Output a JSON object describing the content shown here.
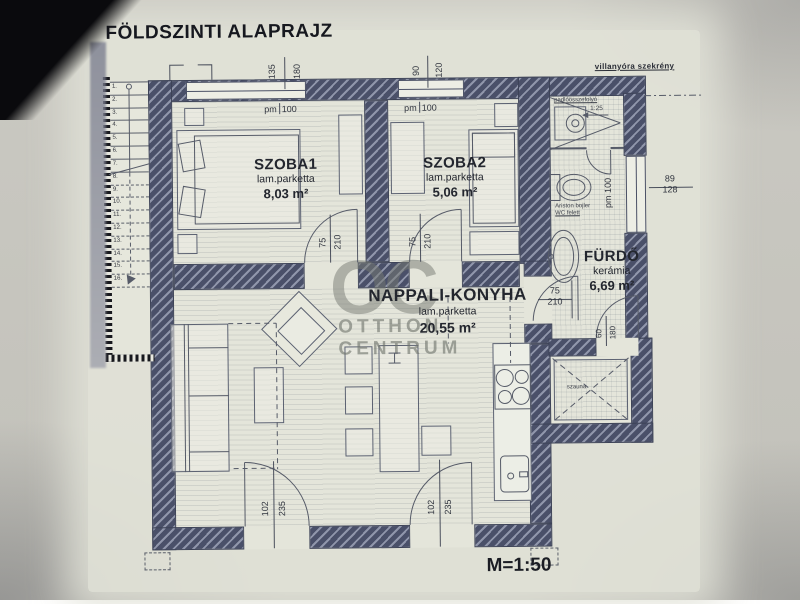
{
  "title": "FÖLDSZINTI ALAPRAJZ",
  "scale_label": "M=1:50",
  "watermark": {
    "monogram": "OC",
    "line1": "OTTHON",
    "line2": "CENTRUM"
  },
  "rooms": {
    "szoba1": {
      "name": "SZOBA1",
      "floor": "lam.parketta",
      "area": "8,03 m²"
    },
    "szoba2": {
      "name": "SZOBA2",
      "floor": "lam.parketta",
      "area": "5,06 m²"
    },
    "nappali": {
      "name": "NAPPALI-KONYHA",
      "floor": "lam.parketta",
      "area": "20,55 m²"
    },
    "furdo": {
      "name": "FÜRDŐ",
      "floor": "kerámia",
      "area": "6,69 m²"
    },
    "szauna": {
      "name": "szauna"
    }
  },
  "annotations": {
    "meter_cabinet": "villanyóra szekrény",
    "drain": "padlóösszefolyó",
    "slope": "1:25",
    "boiler1": "Ariston bojler",
    "boiler2": "WC felett"
  },
  "dims": {
    "win1": {
      "w": "135",
      "h": "180"
    },
    "win2": {
      "w": "90",
      "h": "120"
    },
    "win3": {
      "w": "89",
      "h": "128"
    },
    "door75": {
      "w": "75",
      "h": "210"
    },
    "sauna": {
      "w": "60",
      "h": "180"
    },
    "entry": {
      "w": "102",
      "h": "235"
    },
    "sill": {
      "a": "pm",
      "b": "100"
    }
  },
  "stairs": {
    "steps": [
      "1.",
      "2.",
      "3.",
      "4.",
      "5.",
      "6.",
      "7.",
      "8.",
      "9.",
      "10.",
      "11.",
      "12.",
      "13.",
      "14.",
      "15.",
      "16."
    ]
  },
  "colors": {
    "wall": "#4a5069",
    "paper": "#e4e5da",
    "ink": "#23262e"
  }
}
